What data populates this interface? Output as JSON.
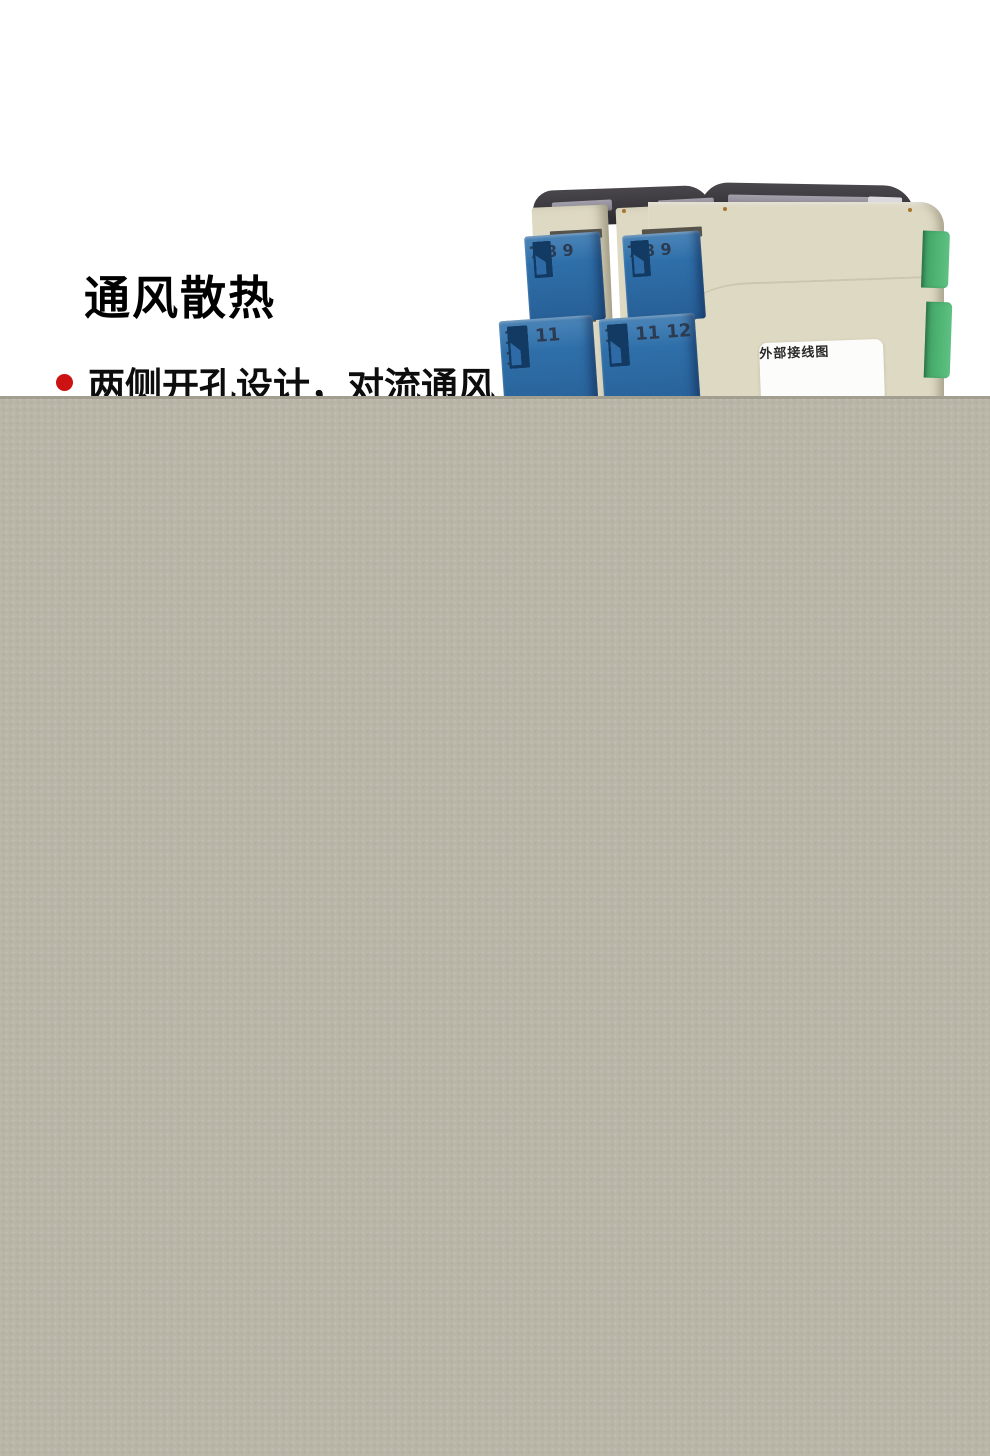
{
  "colors": {
    "page_bg": "#ffffff",
    "overlay": "#b9b6a7",
    "overlay_edge": "#a29f91",
    "bullet_red": "#cc1212",
    "heading_text": "#000000",
    "body_text": "#0d0d0d",
    "housing_cream": "#ded9c3",
    "terminal_blue": "#2f6fa9",
    "connector_green": "#4fb573",
    "cover_dark": "#3a373c",
    "label_bg": "#fcfcfa"
  },
  "section": {
    "heading": "通风散热",
    "bullet": {
      "text": "两侧开孔设计，对流通风"
    }
  },
  "product_photo": {
    "wiring_label": "外部接线图",
    "modules": [
      {
        "top_terminals": [
          "7",
          "8",
          "9"
        ],
        "bottom_terminals": [
          "10",
          "11",
          "12"
        ]
      },
      {
        "top_terminals": [
          "7",
          "8",
          "9"
        ],
        "bottom_terminals": [
          "10",
          "11",
          "12"
        ]
      }
    ]
  }
}
